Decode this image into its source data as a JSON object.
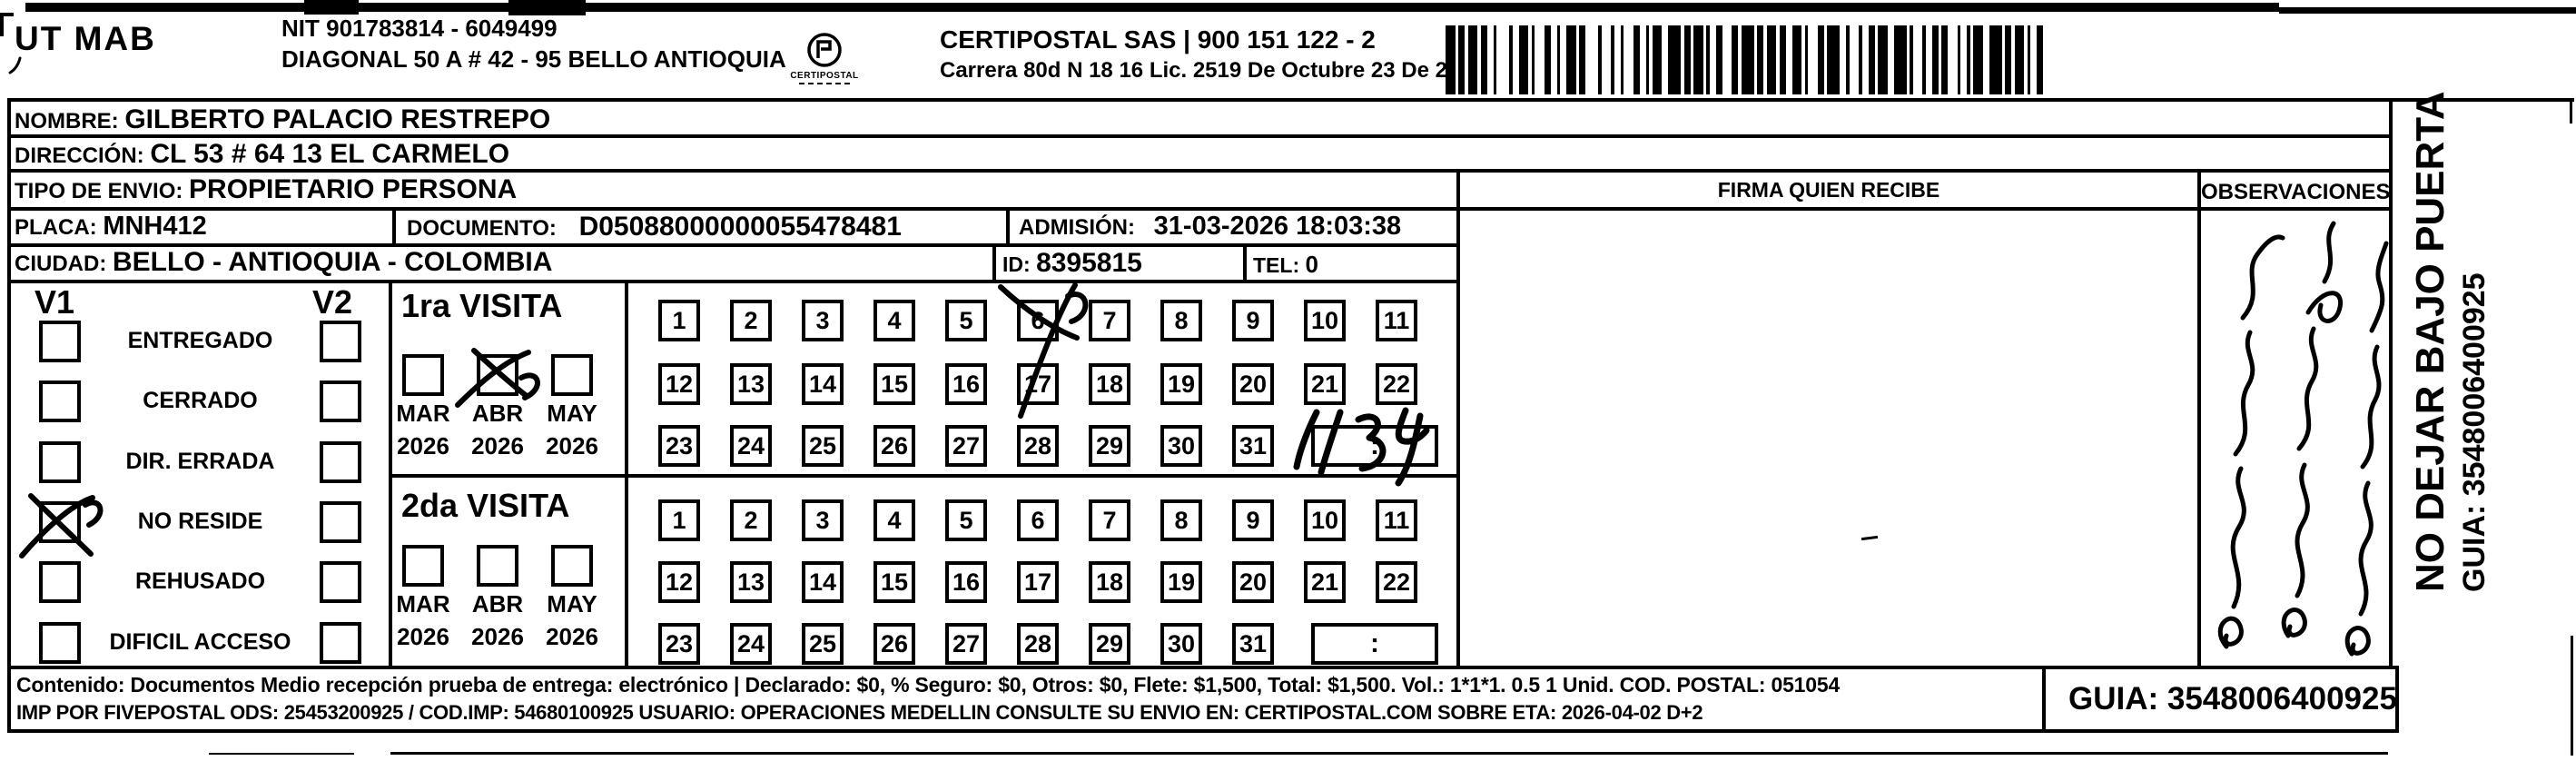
{
  "header": {
    "sender_code": "UT MAB",
    "nit_line": "NIT 901783814 - 6049499",
    "sender_address": "DIAGONAL 50 A # 42 - 95  BELLO  ANTIOQUIA",
    "logo_icon": "certipostal-logo",
    "logo_text": "CERTIPOSTAL",
    "company_line": "CERTIPOSTAL SAS | 900 151 122 - 2",
    "company_address": "Carrera 80d N 18 16  Lic. 2519 De Octubre 23 De 2015",
    "barcode_icon": "barcode"
  },
  "recipient": {
    "nombre_label": "NOMBRE:",
    "nombre": "GILBERTO PALACIO RESTREPO",
    "direccion_label": "DIRECCIÓN:",
    "direccion": "CL 53 # 64 13 EL CARMELO",
    "tipo_label": "TIPO DE ENVIO:",
    "tipo": "PROPIETARIO PERSONA",
    "placa_label": "PLACA:",
    "placa": "MNH412",
    "documento_label": "DOCUMENTO:",
    "documento": "D05088000000055478481",
    "admision_label": "ADMISIÓN:",
    "admision": "31-03-2026 18:03:38",
    "ciudad_label": "CIUDAD:",
    "ciudad": "BELLO - ANTIOQUIA - COLOMBIA",
    "id_label": "ID:",
    "id_value": "8395815",
    "tel_label": "TEL:",
    "tel_value": "0"
  },
  "firma": {
    "title": "FIRMA QUIEN RECIBE"
  },
  "observaciones": {
    "title": "OBSERVACIONES",
    "handwritten_note": "illegible handwritten note"
  },
  "side_note": {
    "line1": "NO DEJAR BAJO PUERTA",
    "line2": "GUIA: 3548006400925"
  },
  "status": {
    "v1_label": "V1",
    "v2_label": "V2",
    "items": [
      {
        "label": "ENTREGADO",
        "v1_checked": false,
        "v2_checked": false
      },
      {
        "label": "CERRADO",
        "v1_checked": false,
        "v2_checked": false
      },
      {
        "label": "DIR. ERRADA",
        "v1_checked": false,
        "v2_checked": false
      },
      {
        "label": "NO RESIDE",
        "v1_checked": true,
        "v2_checked": false
      },
      {
        "label": "REHUSADO",
        "v1_checked": false,
        "v2_checked": false
      },
      {
        "label": "DIFICIL ACCESO",
        "v1_checked": false,
        "v2_checked": false
      }
    ]
  },
  "visits": [
    {
      "title": "1ra VISITA",
      "months": [
        {
          "label": "MAR",
          "year": "2026",
          "checked": false
        },
        {
          "label": "ABR",
          "year": "2026",
          "checked": true
        },
        {
          "label": "MAY",
          "year": "2026",
          "checked": false
        }
      ],
      "days": [
        1,
        2,
        3,
        4,
        5,
        6,
        7,
        8,
        9,
        10,
        11,
        12,
        13,
        14,
        15,
        16,
        17,
        18,
        19,
        20,
        21,
        22,
        23,
        24,
        25,
        26,
        27,
        28,
        29,
        30,
        31
      ],
      "marked_day": 6,
      "time_box_printed": ":",
      "time_handwritten": "11:34"
    },
    {
      "title": "2da VISITA",
      "months": [
        {
          "label": "MAR",
          "year": "2026",
          "checked": false
        },
        {
          "label": "ABR",
          "year": "2026",
          "checked": false
        },
        {
          "label": "MAY",
          "year": "2026",
          "checked": false
        }
      ],
      "days": [
        1,
        2,
        3,
        4,
        5,
        6,
        7,
        8,
        9,
        10,
        11,
        12,
        13,
        14,
        15,
        16,
        17,
        18,
        19,
        20,
        21,
        22,
        23,
        24,
        25,
        26,
        27,
        28,
        29,
        30,
        31
      ],
      "marked_day": null,
      "time_box_printed": ":",
      "time_handwritten": ""
    }
  ],
  "footer": {
    "line1": "Contenido: Documentos Medio recepción prueba de entrega: electrónico | Declarado: $0, % Seguro: $0, Otros: $0, Flete: $1,500, Total: $1,500. Vol.: 1*1*1. 0.5 1 Unid. COD. POSTAL: 051054",
    "line2": "IMP POR FIVEPOSTAL ODS: 25453200925 / COD.IMP: 54680100925 USUARIO: OPERACIONES MEDELLIN CONSULTE SU ENVIO EN: CERTIPOSTAL.COM SOBRE ETA: 2026-04-02 D+2",
    "guia": "GUIA: 3548006400925"
  },
  "colors": {
    "ink": "#000000",
    "paper": "#ffffff"
  }
}
